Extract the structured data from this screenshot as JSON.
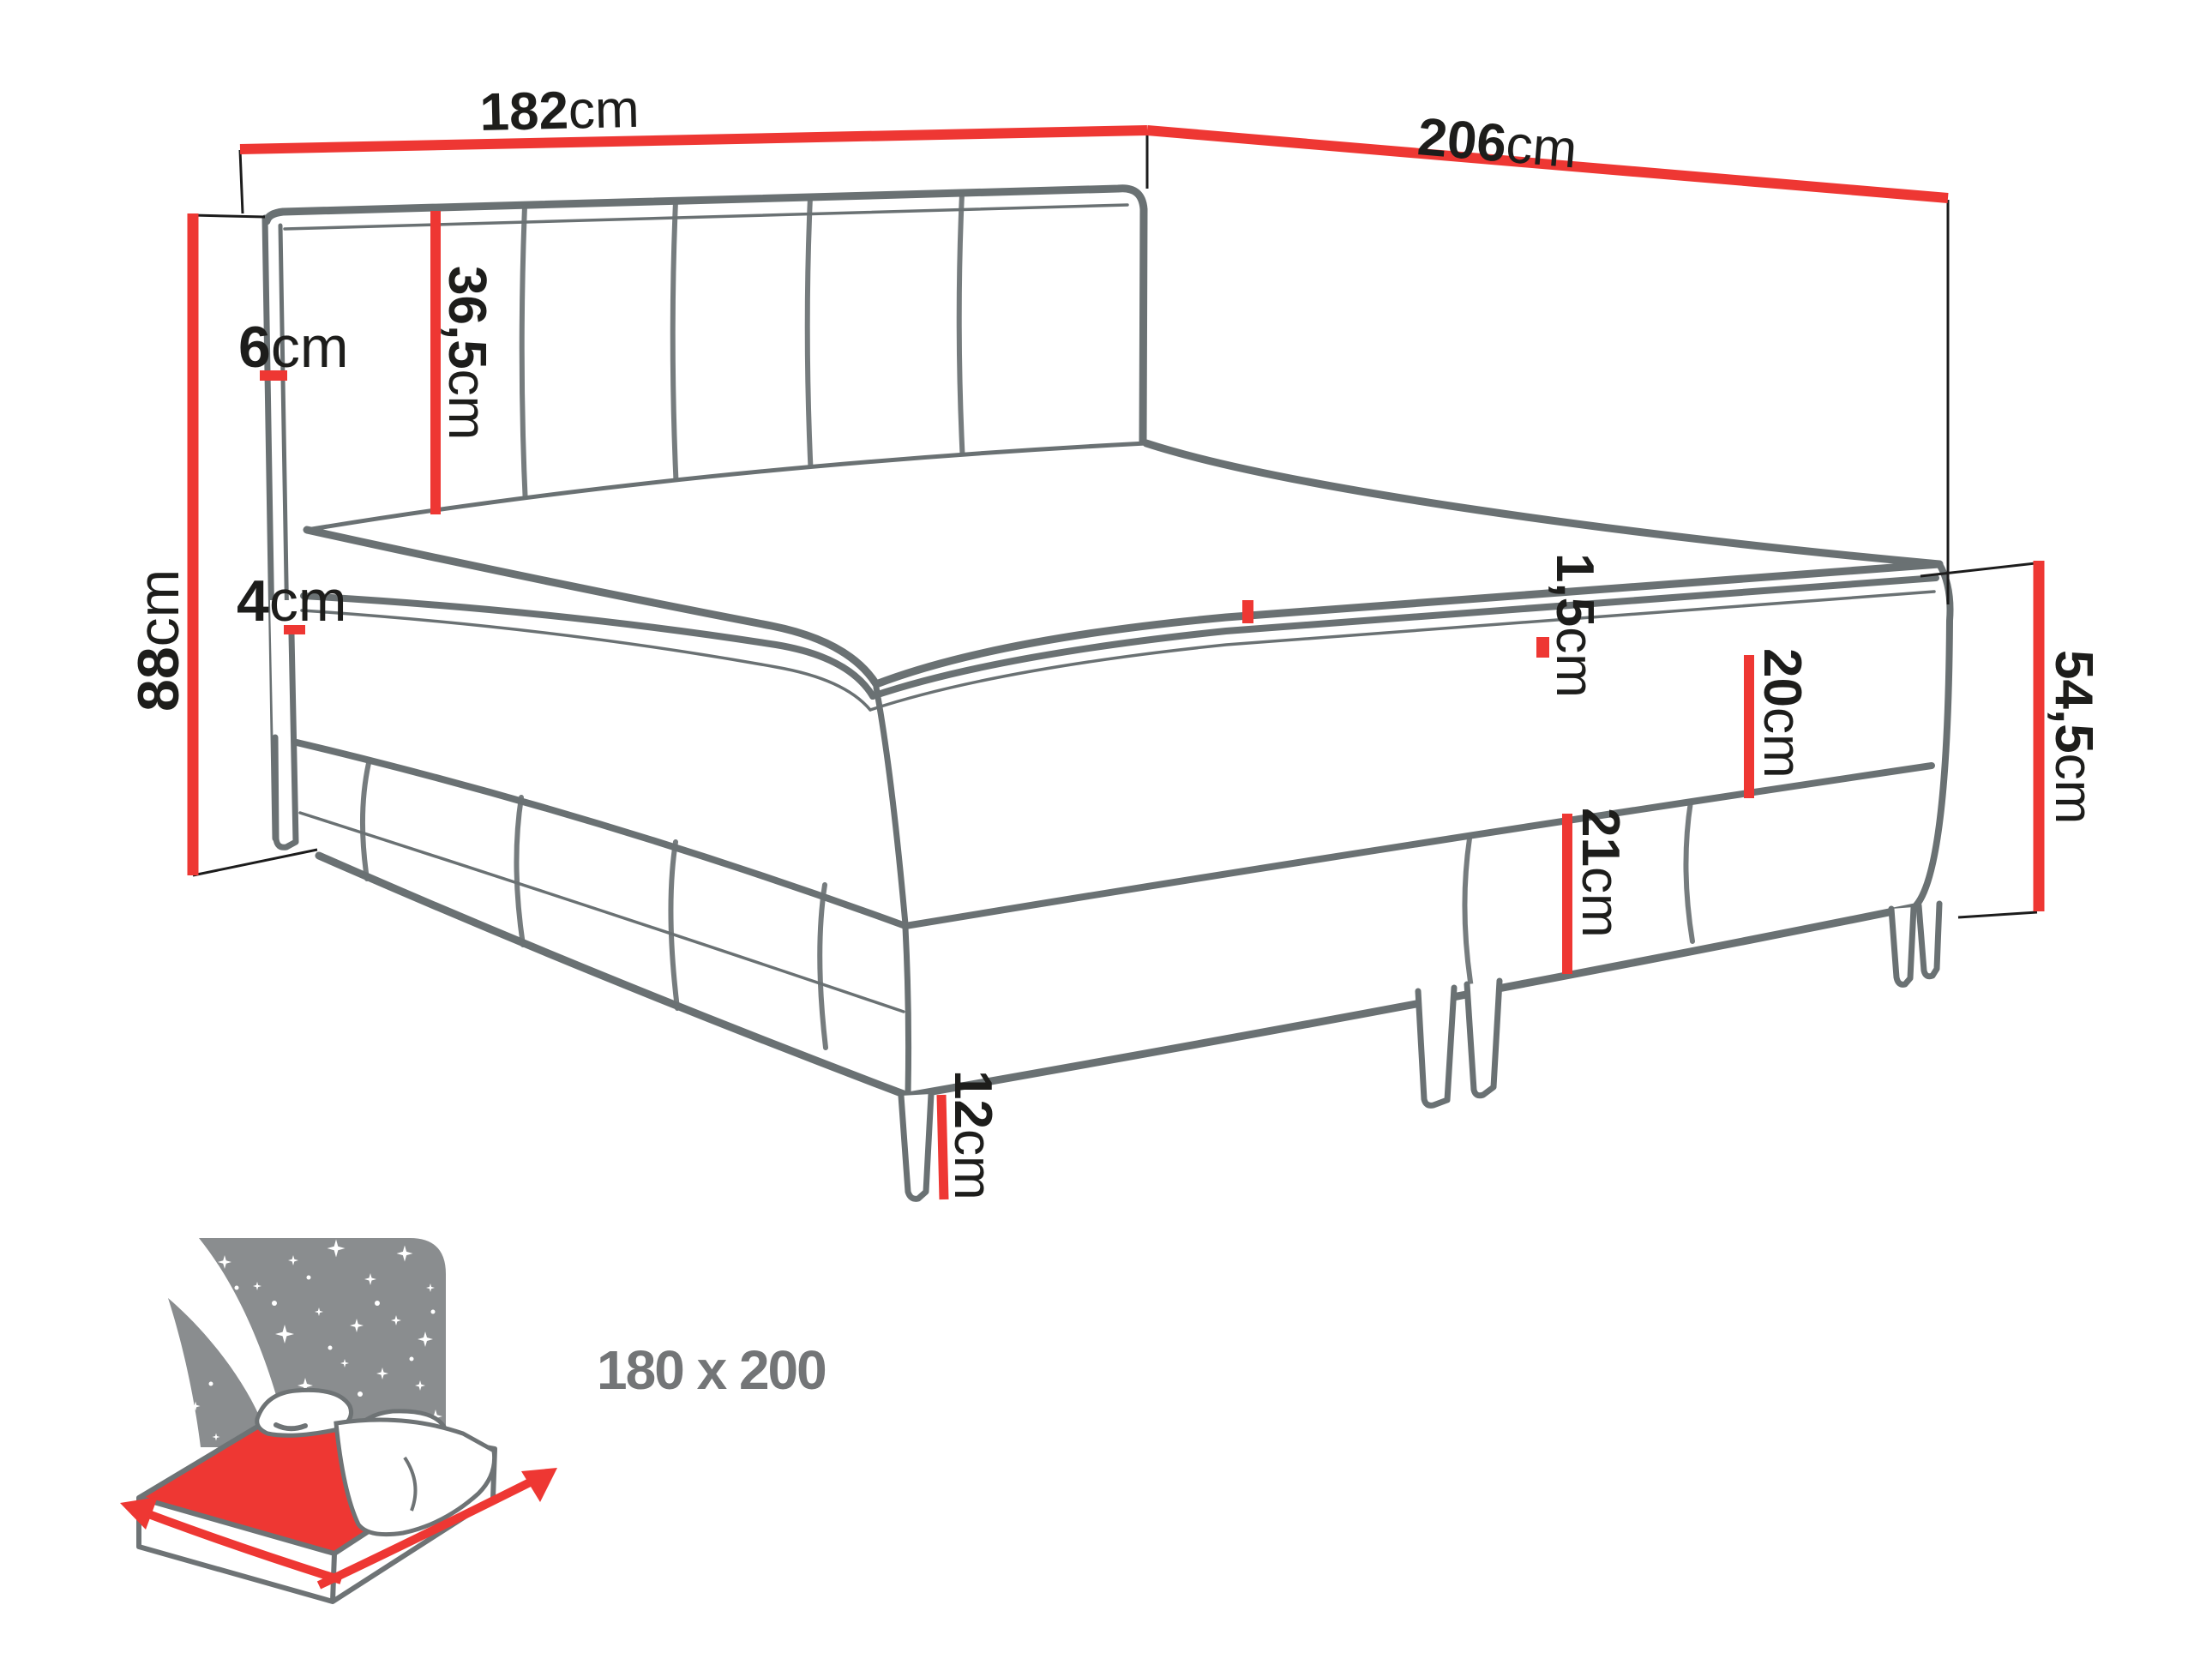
{
  "diagram": {
    "type": "bed-dimension-diagram",
    "product": "boxspring-bed",
    "size_badge": {
      "label": "180 x 200"
    },
    "dimensions": {
      "headboard_width": {
        "number": "182",
        "unit": "cm"
      },
      "bed_length": {
        "number": "206",
        "unit": "cm"
      },
      "headboard_height": {
        "number": "88",
        "unit": "cm"
      },
      "headboard_thickness": {
        "number": "6",
        "unit": "cm"
      },
      "headboard_panel_height": {
        "number": "36,5",
        "unit": "cm"
      },
      "topper_height": {
        "number": "4",
        "unit": "cm"
      },
      "topper_seam_height": {
        "number": "1,5",
        "unit": "cm"
      },
      "mattress_height": {
        "number": "20",
        "unit": "cm"
      },
      "box_height": {
        "number": "21",
        "unit": "cm"
      },
      "leg_height": {
        "number": "12",
        "unit": "cm"
      },
      "side_total_height": {
        "number": "54,5",
        "unit": "cm"
      }
    },
    "colors": {
      "dimension_red": "#ee3733",
      "outline_gray": "#6a7173",
      "connector_black": "#1c1c1c",
      "label_black": "#1d1d1b",
      "icon_gray": "#8a8d8f",
      "size_text_gray": "#737577"
    }
  }
}
